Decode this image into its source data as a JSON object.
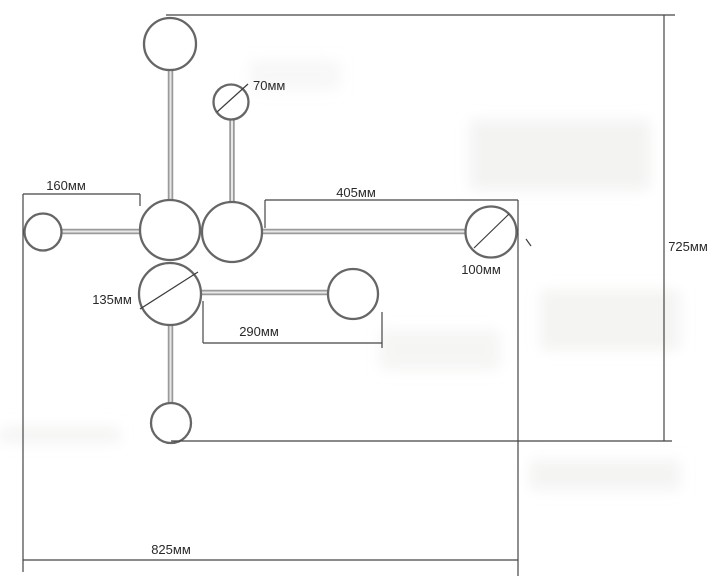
{
  "meta": {
    "type": "technical-drawing",
    "subject": "chandelier fixture plan with dimensions",
    "unit": "мм"
  },
  "colors": {
    "background": "#ffffff",
    "bulb_outline": "#666666",
    "dimension_line": "#454545",
    "arm_stroke": "#9a9a9a",
    "text": "#2a2a2a"
  },
  "dimensions": {
    "small_bulb_diameter": "70мм",
    "left_arm_length": "160мм",
    "right_arm_length": "405мм",
    "right_bulb_diameter": "100мм",
    "center_bulb_diameter": "135мм",
    "lower_arm_length": "290мм",
    "overall_height": "725мм",
    "overall_width": "825мм"
  }
}
